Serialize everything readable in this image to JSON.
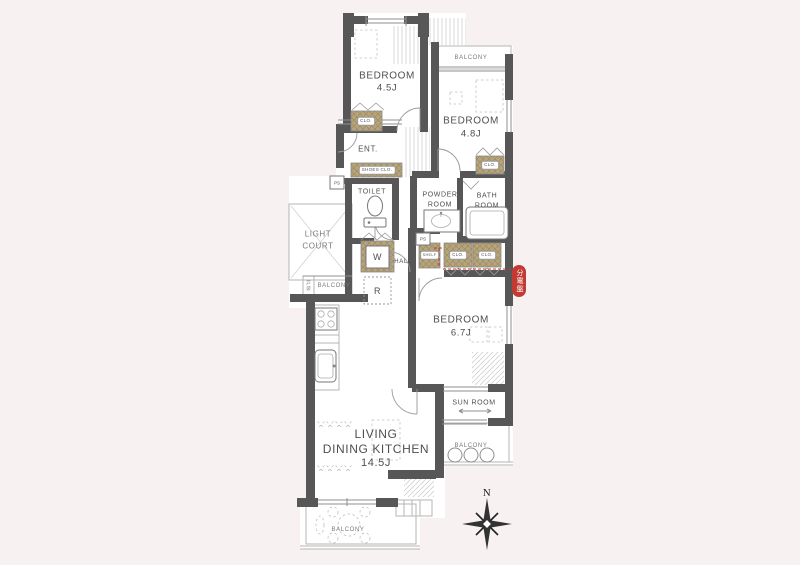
{
  "plan": {
    "rooms": {
      "bedroom_top": {
        "name": "BEDROOM",
        "size": "4.5J"
      },
      "bedroom_right": {
        "name": "BEDROOM",
        "size": "4.8J"
      },
      "bedroom_middle": {
        "name": "BEDROOM",
        "size": "6.7J"
      },
      "ldk": {
        "line1": "LIVING",
        "line2": "DINING KITCHEN",
        "size": "14.5J"
      },
      "entrance": "ENT.",
      "toilet": "TOILET",
      "powder_room": {
        "line1": "POWDER",
        "line2": "ROOM"
      },
      "bath_room": {
        "line1": "BATH",
        "line2": "ROOM"
      },
      "light_court": {
        "line1": "LIGHT",
        "line2": "COURT"
      },
      "hall": "HALL",
      "sun_room": "SUN ROOM",
      "balcony": "BALCONY"
    },
    "fixtures": {
      "closet": "CLO.",
      "shoes_closet": "SHOES CLO.",
      "shelf": "SHELF",
      "washer": "W",
      "refrigerator": "R",
      "pipe_space": "PS",
      "shutter_box": "戸袋"
    },
    "labels": {
      "distribution_board": "分電盤",
      "north": "N"
    },
    "colors": {
      "wall": "#575757",
      "closet": "#b6a47c",
      "accent": "#c23a32",
      "background": "#f8f1f2",
      "floor": "#ffffff"
    }
  }
}
